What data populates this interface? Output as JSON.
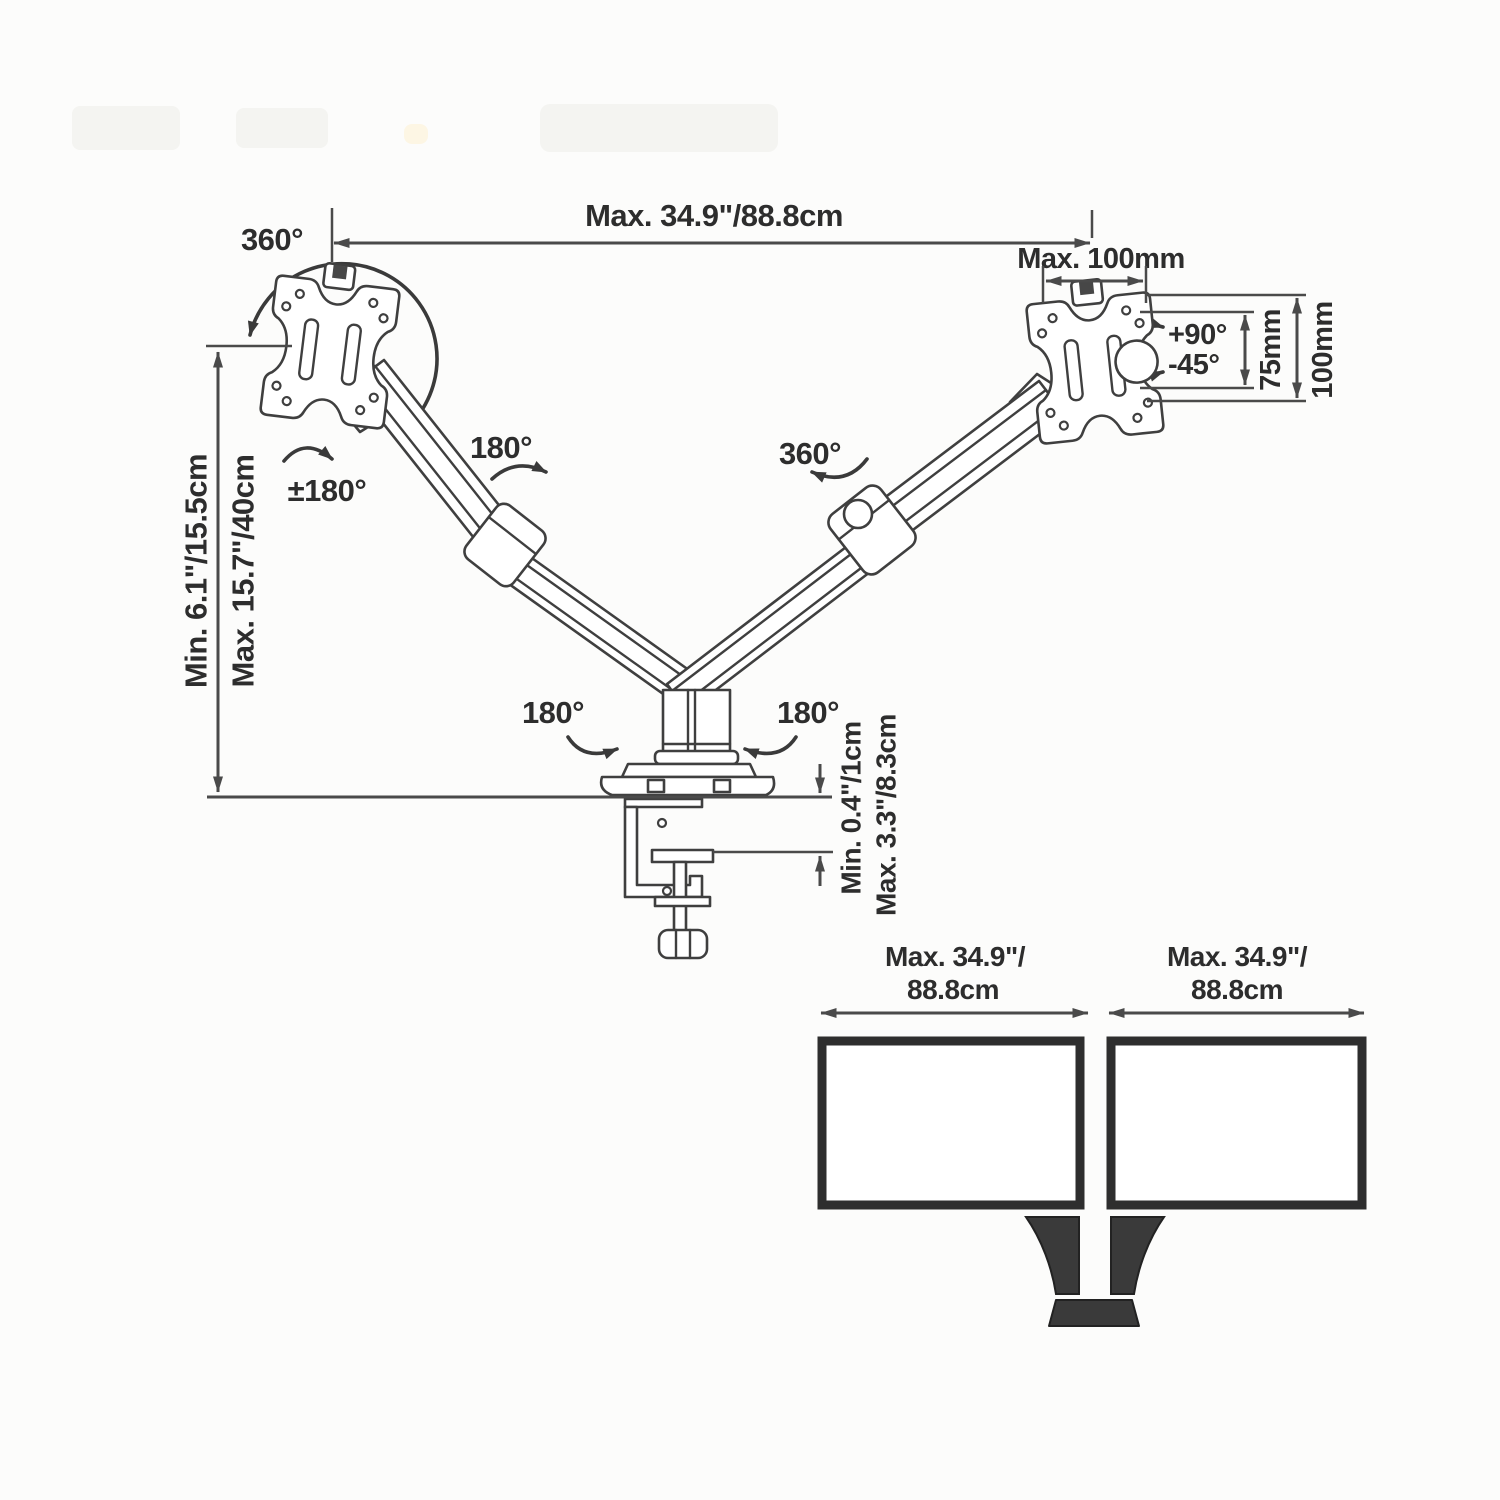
{
  "meta": {
    "title": "Dual monitor desk mount arm - specification diagram"
  },
  "colors": {
    "background": "#fcfcfb",
    "drawing_line": "#3f3f3f",
    "dimension_line": "#4a4a4a",
    "text": "#2d2d2d",
    "stand_fill": "#333333"
  },
  "dimensions": {
    "top_span": "Max. 34.9\"/88.8cm",
    "vesa_width": "Max. 100mm",
    "vesa_hole_75": "75mm",
    "vesa_hole_100": "100mm",
    "height_min": "Min. 6.1\"/15.5cm",
    "height_max": "Max. 15.7\"/40cm",
    "clamp_min": "Min. 0.4\"/1cm",
    "clamp_max": "Max. 3.3\"/8.3cm"
  },
  "rotations": {
    "plate_left_swivel": "360°",
    "plate_left_rotate": "±180°",
    "arm_left_elbow": "180°",
    "arm_right_elbow": "360°",
    "base_left": "180°",
    "base_right": "180°",
    "tilt_up": "+90°",
    "tilt_down": "-45°"
  },
  "monitor_spans": {
    "left": {
      "line1": "Max. 34.9\"/",
      "line2": "88.8cm"
    },
    "right": {
      "line1": "Max. 34.9\"/",
      "line2": "88.8cm"
    }
  }
}
